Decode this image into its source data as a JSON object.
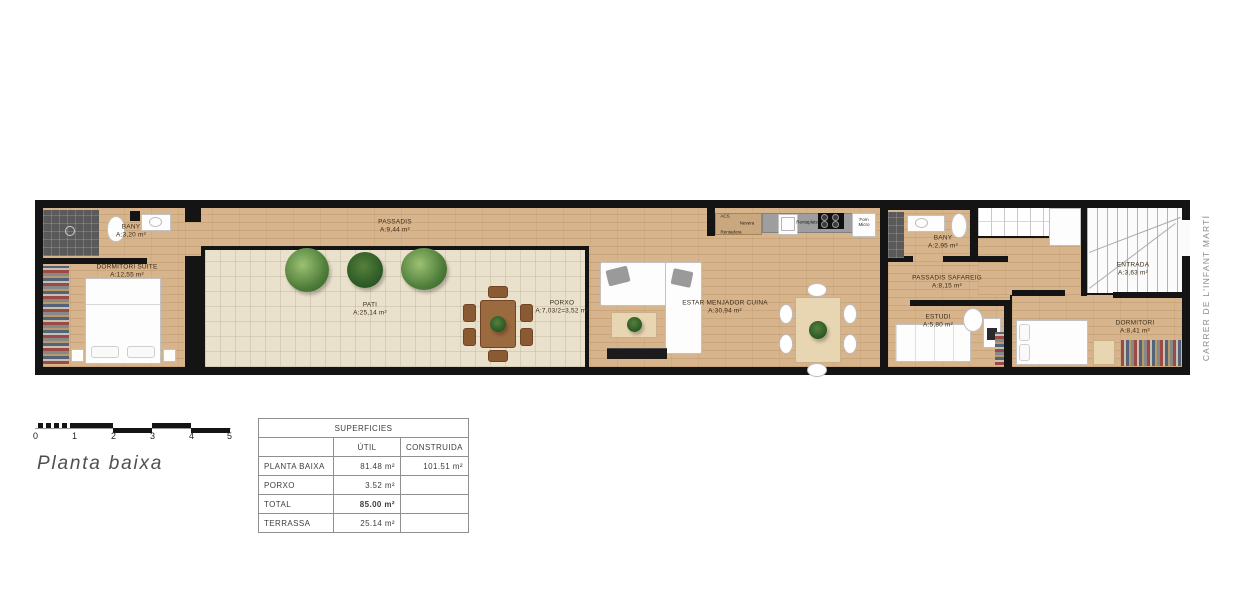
{
  "plan": {
    "street": "CARRER DE L'INFANT MARTÍ",
    "rooms": [
      {
        "id": "bany-suite",
        "name": "BANY",
        "area": "A:3,20 m²"
      },
      {
        "id": "dormitori-suite",
        "name": "DORMITORI SUITE",
        "area": "A:12,55 m²"
      },
      {
        "id": "passadis",
        "name": "PASSADIS",
        "area": "A:9,44 m²"
      },
      {
        "id": "pati",
        "name": "PATI",
        "area": "A:25,14 m²"
      },
      {
        "id": "porxo",
        "name": "PORXO",
        "area": "A:7,03/2=3,52 m²"
      },
      {
        "id": "estar-menjador-cuina",
        "name": "ESTAR MENJADOR CUINA",
        "area": "A:30,94 m²"
      },
      {
        "id": "bany",
        "name": "BANY",
        "area": "A:2,95 m²"
      },
      {
        "id": "passadis-safareig",
        "name": "PASSADIS SAFAREIG",
        "area": "A:8,15 m²"
      },
      {
        "id": "estudi",
        "name": "ESTUDI",
        "area": "A:5,80 m²"
      },
      {
        "id": "dormitori",
        "name": "DORMITORI",
        "area": "A:8,41 m²"
      },
      {
        "id": "entrada",
        "name": "ENTRADA",
        "area": "A:3,63 m²"
      }
    ],
    "kitchen": {
      "acs": "ACS",
      "nevera": "Nevera",
      "rentadora": "Rentadora",
      "rentaplats": "Rentaplats",
      "forn_micro": "Forn Micro"
    }
  },
  "scale_bar": {
    "ticks": [
      "0",
      "1",
      "2",
      "3",
      "4",
      "5"
    ]
  },
  "title": "Planta baixa",
  "table": {
    "header": "SUPERFICIES",
    "columns": {
      "util": "ÚTIL",
      "construida": "CONSTRUIDA"
    },
    "rows": [
      {
        "label": "PLANTA BAIXA",
        "util": "81.48 m²",
        "construida": "101.51 m²"
      },
      {
        "label": "PORXO",
        "util": "3.52 m²",
        "construida": ""
      },
      {
        "label": "TOTAL",
        "util": "85.00 m²",
        "construida": ""
      },
      {
        "label": "TERRASSA",
        "util": "25.14 m²",
        "construida": ""
      }
    ]
  }
}
